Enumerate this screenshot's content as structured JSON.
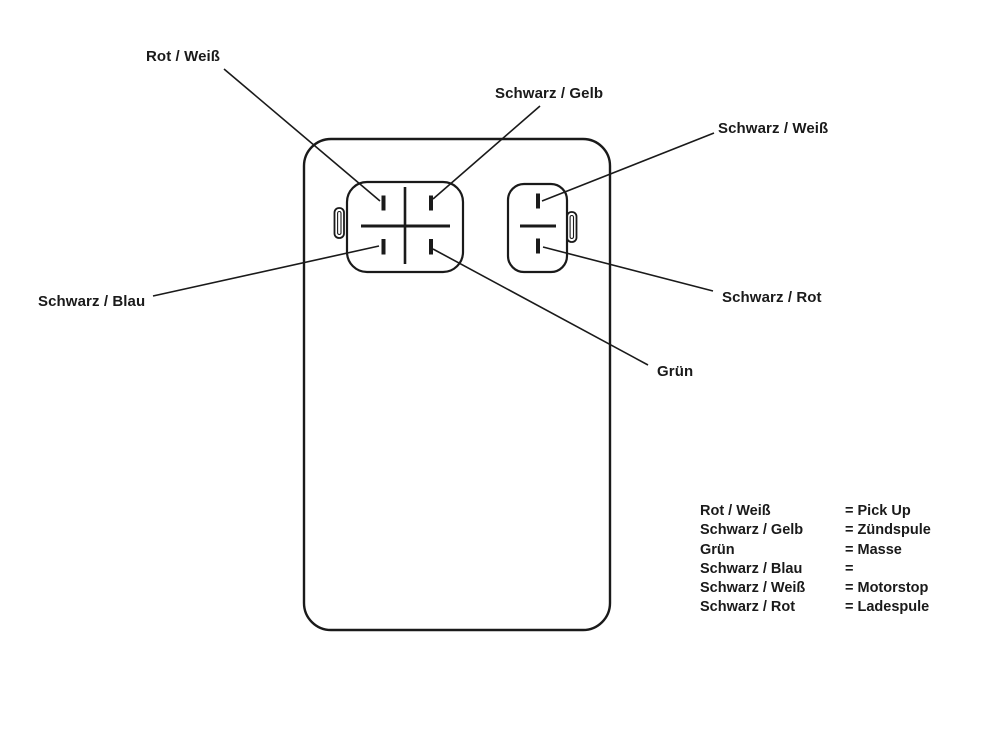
{
  "page": {
    "background_color": "#ffffff",
    "ink_color": "#1a1a1a",
    "description": "CDI unit connector pinout wiring diagram with German wire-color callouts"
  },
  "callouts": [
    {
      "id": "rot-weiss",
      "label": "Rot / Weiß"
    },
    {
      "id": "schwarz-gelb",
      "label": "Schwarz / Gelb"
    },
    {
      "id": "schwarz-weiss",
      "label": "Schwarz / Weiß"
    },
    {
      "id": "schwarz-blau",
      "label": "Schwarz / Blau"
    },
    {
      "id": "gruen",
      "label": "Grün"
    },
    {
      "id": "schwarz-rot",
      "label": "Schwarz / Rot"
    }
  ],
  "legend": {
    "rows": [
      {
        "wire": "Rot / Weiß",
        "value": "= Pick Up"
      },
      {
        "wire": "Schwarz / Gelb",
        "value": "= Zündspule"
      },
      {
        "wire": "Grün",
        "value": "= Masse"
      },
      {
        "wire": "Schwarz / Blau",
        "value": "="
      },
      {
        "wire": "Schwarz / Weiß",
        "value": "= Motorstop"
      },
      {
        "wire": "Schwarz / Rot",
        "value": "= Ladespule"
      }
    ]
  }
}
